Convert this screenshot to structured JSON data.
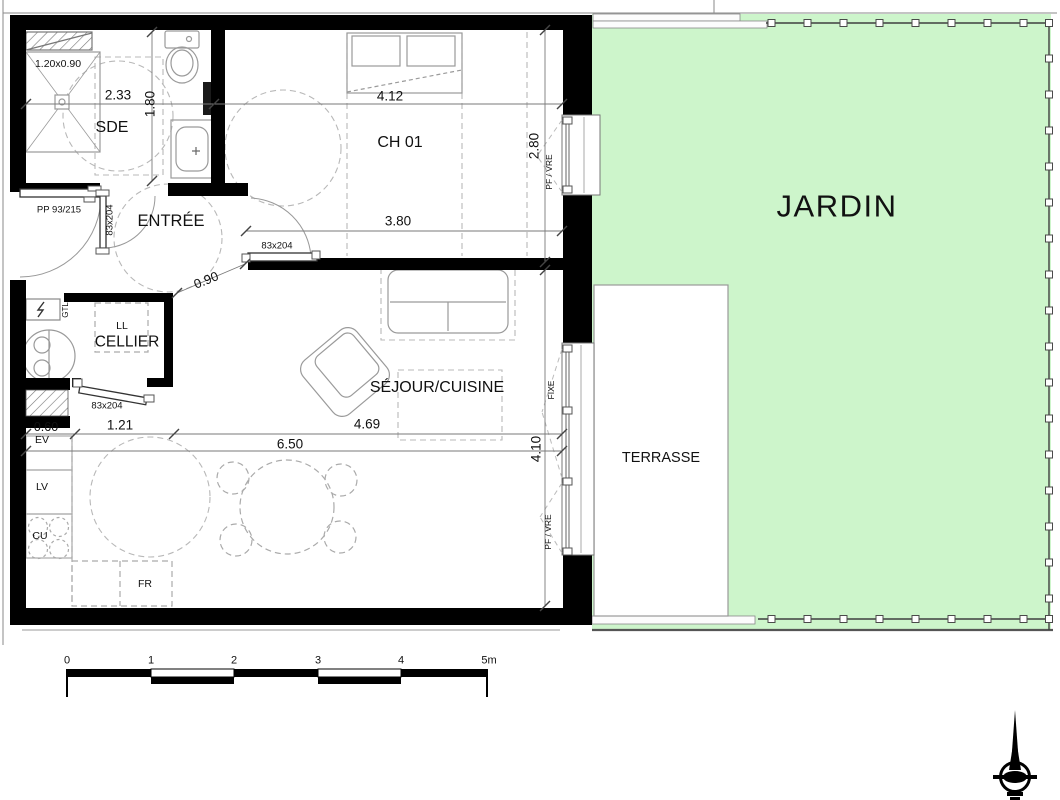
{
  "document": {
    "type": "architectural-floor-plan",
    "units": "m"
  },
  "colors": {
    "garden": "#cdf5cb",
    "wall": "#000000",
    "fixture": "#9a9a9a",
    "dashed": "#b8b8b8",
    "dim_line": "#777777",
    "text": "#111111",
    "fence": "#3f3f3f",
    "terrace": "#ffffff"
  },
  "rooms": [
    {
      "id": "sde",
      "label": "SDE",
      "dims": [
        "2.33",
        "1.80"
      ]
    },
    {
      "id": "entree",
      "label": "ENTRÉE"
    },
    {
      "id": "ch01",
      "label": "CH 01",
      "dims": [
        "4.12",
        "3.80",
        "2.80"
      ]
    },
    {
      "id": "cellier",
      "label": "CELLIER"
    },
    {
      "id": "sejour-cuisine",
      "label": "SÉJOUR/CUISINE",
      "dims": [
        "6.50",
        "4.69",
        "4.10",
        "1.21",
        "0.60",
        "0.90"
      ]
    },
    {
      "id": "terrasse",
      "label": "TERRASSE"
    },
    {
      "id": "jardin",
      "label": "JARDIN"
    }
  ],
  "doors": [
    {
      "id": "entrance-door",
      "label": "PP 93/215"
    },
    {
      "id": "sde-door",
      "label": "83x204"
    },
    {
      "id": "ch01-door",
      "label": "83x204"
    },
    {
      "id": "cellier-door",
      "label": "83x204"
    }
  ],
  "windows": [
    {
      "id": "ch01-window",
      "labels": [
        "2.80",
        "PF / VRE"
      ]
    },
    {
      "id": "sejour-window",
      "labels": [
        "FIXE",
        "PF / VRE"
      ]
    }
  ],
  "equipment": [
    {
      "id": "shower",
      "label": "1.20x0.90"
    },
    {
      "id": "gtl",
      "label": "GTL"
    },
    {
      "id": "washer",
      "label": "LL"
    },
    {
      "id": "sink",
      "label": "EV"
    },
    {
      "id": "dishwasher",
      "label": "LV"
    },
    {
      "id": "cooktop",
      "label": "CU"
    },
    {
      "id": "fridge",
      "label": "FR"
    }
  ],
  "scale_bar": {
    "unit": "m",
    "ticks": [
      "0",
      "1",
      "2",
      "3",
      "4",
      "5m"
    ]
  },
  "labels": [
    {
      "id": "shower-dim",
      "text": "1.20x0.90",
      "x": 58,
      "y": 64,
      "size": 10.5
    },
    {
      "id": "sde-width-dim",
      "text": "2.33",
      "x": 118,
      "y": 95,
      "size": 13.5
    },
    {
      "id": "sde-depth-dim",
      "text": "1.80",
      "x": 150,
      "y": 104,
      "size": 13.5,
      "rot": -90
    },
    {
      "id": "room-sde",
      "text": "SDE",
      "x": 112,
      "y": 128,
      "size": 16
    },
    {
      "id": "ch01-width-dim",
      "text": "4.12",
      "x": 390,
      "y": 96,
      "size": 13.5
    },
    {
      "id": "room-ch01",
      "text": "CH 01",
      "x": 400,
      "y": 143,
      "size": 16
    },
    {
      "id": "ch01-window-dim",
      "text": "2.80",
      "x": 534,
      "y": 146,
      "size": 13.5,
      "rot": -90
    },
    {
      "id": "ch01-window-type",
      "text": "PF / VRE",
      "x": 549,
      "y": 172,
      "size": 8.5,
      "rot": -90
    },
    {
      "id": "entrance-door-label",
      "text": "PP 93/215",
      "x": 59,
      "y": 210,
      "size": 9.5
    },
    {
      "id": "sde-door-label",
      "text": "83x204",
      "x": 110,
      "y": 220,
      "size": 9.5,
      "rot": -90
    },
    {
      "id": "room-entree",
      "text": "ENTRÉE",
      "x": 171,
      "y": 221,
      "size": 16.5
    },
    {
      "id": "dim-380",
      "text": "3.80",
      "x": 398,
      "y": 221,
      "size": 13.5
    },
    {
      "id": "ch01-door-label",
      "text": "83x204",
      "x": 277,
      "y": 246,
      "size": 9.5
    },
    {
      "id": "dim-090",
      "text": "0.90",
      "x": 206,
      "y": 280,
      "size": 13,
      "rot": -22
    },
    {
      "id": "gtl-label",
      "text": "GTL",
      "x": 66,
      "y": 310,
      "size": 8,
      "rot": -90
    },
    {
      "id": "ll-label",
      "text": "LL",
      "x": 122,
      "y": 326,
      "size": 10.5
    },
    {
      "id": "room-cellier",
      "text": "CELLIER",
      "x": 127,
      "y": 342,
      "size": 15.5
    },
    {
      "id": "cellier-door-label",
      "text": "83x204",
      "x": 107,
      "y": 406,
      "size": 9.5
    },
    {
      "id": "dim-060",
      "text": "0.60",
      "x": 46,
      "y": 427,
      "size": 12.5
    },
    {
      "id": "ev-label",
      "text": "EV",
      "x": 42,
      "y": 440,
      "size": 10.5
    },
    {
      "id": "dim-121",
      "text": "1.21",
      "x": 120,
      "y": 425,
      "size": 13.5
    },
    {
      "id": "dim-469",
      "text": "4.69",
      "x": 367,
      "y": 424,
      "size": 13.5
    },
    {
      "id": "dim-650",
      "text": "6.50",
      "x": 290,
      "y": 444,
      "size": 13.5
    },
    {
      "id": "lv-label",
      "text": "LV",
      "x": 42,
      "y": 487,
      "size": 10.5
    },
    {
      "id": "cu-label",
      "text": "CU",
      "x": 40,
      "y": 536,
      "size": 10.5
    },
    {
      "id": "fr-label",
      "text": "FR",
      "x": 145,
      "y": 584,
      "size": 10.5
    },
    {
      "id": "room-sejour",
      "text": "SÉJOUR/CUISINE",
      "x": 437,
      "y": 388,
      "size": 16
    },
    {
      "id": "sejour-window-fixe",
      "text": "FIXE",
      "x": 551,
      "y": 390,
      "size": 8.5,
      "rot": -90
    },
    {
      "id": "dim-410",
      "text": "4.10",
      "x": 536,
      "y": 449,
      "size": 13.5,
      "rot": -90
    },
    {
      "id": "sejour-window-type",
      "text": "PF / VRE",
      "x": 548,
      "y": 532,
      "size": 8.5,
      "rot": -90
    },
    {
      "id": "room-terrasse",
      "text": "TERRASSE",
      "x": 661,
      "y": 458,
      "size": 14.5
    },
    {
      "id": "room-jardin",
      "text": "JARDIN",
      "x": 837,
      "y": 206,
      "size": 31,
      "ls": 1.5
    },
    {
      "id": "scale-tick-0",
      "text": "0",
      "x": 67,
      "y": 661,
      "size": 11
    },
    {
      "id": "scale-tick-1",
      "text": "1",
      "x": 151,
      "y": 661,
      "size": 11
    },
    {
      "id": "scale-tick-2",
      "text": "2",
      "x": 234,
      "y": 661,
      "size": 11
    },
    {
      "id": "scale-tick-3",
      "text": "3",
      "x": 318,
      "y": 661,
      "size": 11
    },
    {
      "id": "scale-tick-4",
      "text": "4",
      "x": 401,
      "y": 661,
      "size": 11
    },
    {
      "id": "scale-tick-5",
      "text": "5m",
      "x": 489,
      "y": 661,
      "size": 11
    }
  ]
}
